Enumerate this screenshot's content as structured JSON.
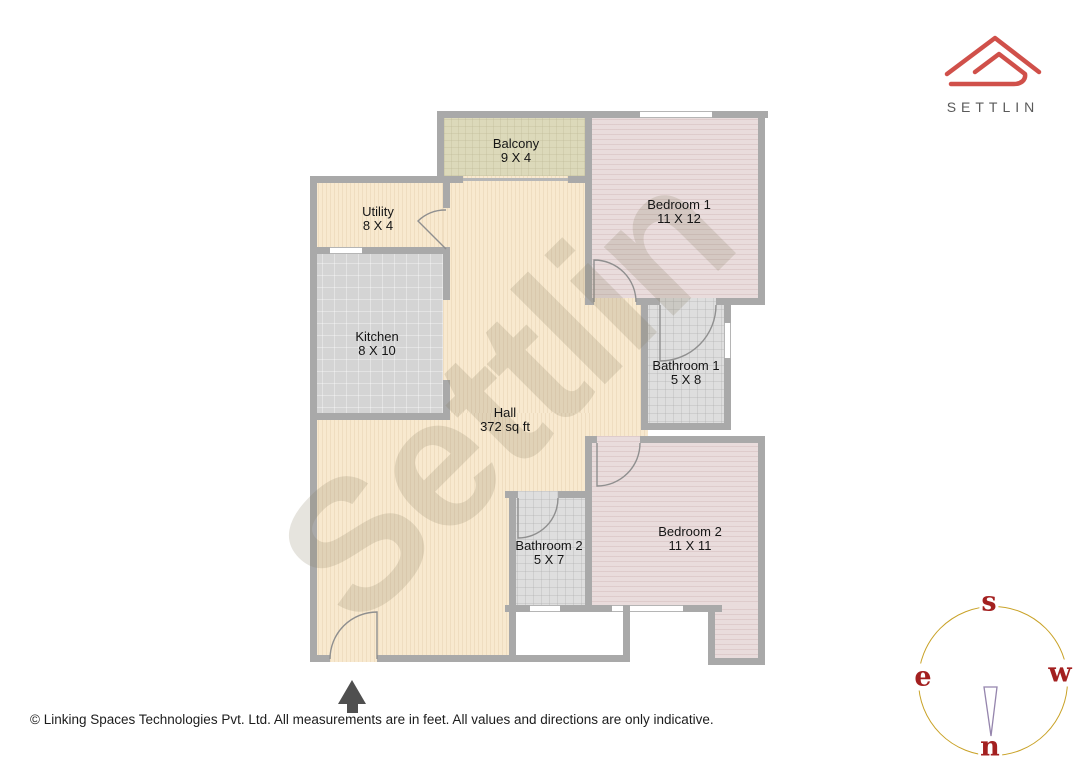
{
  "branding": {
    "logo_icon": "settlin-roof-logo",
    "logo_text": "SETTLIN"
  },
  "watermark": {
    "text": "Settlin"
  },
  "floorplan": {
    "rooms": [
      {
        "id": "balcony",
        "name": "Balcony",
        "dims": "9 X 4"
      },
      {
        "id": "bedroom1",
        "name": "Bedroom 1",
        "dims": "11 X 12"
      },
      {
        "id": "utility",
        "name": "Utility",
        "dims": "8 X 4"
      },
      {
        "id": "kitchen",
        "name": "Kitchen",
        "dims": "8 X 10"
      },
      {
        "id": "hall",
        "name": "Hall",
        "dims": "372 sq ft"
      },
      {
        "id": "bathroom1",
        "name": "Bathroom 1",
        "dims": "5 X 8"
      },
      {
        "id": "bathroom2",
        "name": "Bathroom 2",
        "dims": "5 X 7"
      },
      {
        "id": "bedroom2",
        "name": "Bedroom 2",
        "dims": "11 X 11"
      }
    ]
  },
  "compass": {
    "labels": {
      "top": "s",
      "left": "e",
      "right": "w",
      "bottom": "n"
    }
  },
  "footer": {
    "text": "© Linking Spaces Technologies Pvt. Ltd. All measurements are in feet. All values and directions are only indicative."
  },
  "colors": {
    "wall": "#a9a9a9",
    "cream": "#f8e9cf",
    "balcony": "#dcd9ba",
    "bedroom": "#e9dcdc",
    "kitchen": "#d4d4d4",
    "bath": "#dedede",
    "compass": "#c9a227",
    "cletter": "#a32020",
    "logo": "#d0504a"
  }
}
